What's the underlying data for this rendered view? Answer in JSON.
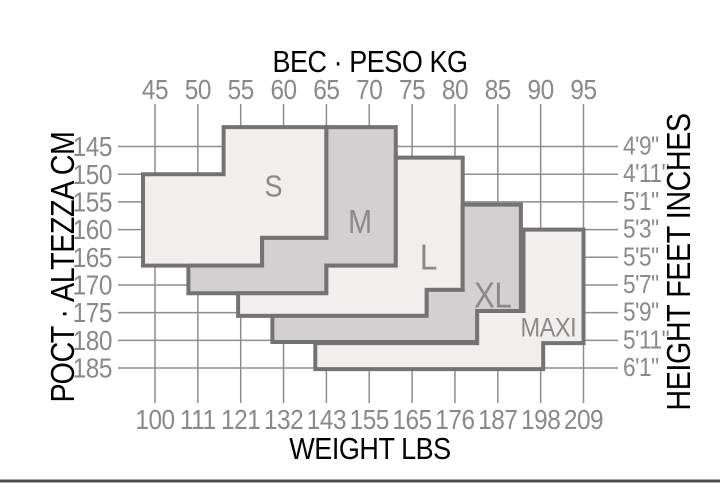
{
  "page": {
    "background": "#ffffff"
  },
  "chart_data": {
    "type": "area",
    "subtype": "stepped-size-regions",
    "title_top": "ВЕС · PESO KG",
    "title_bottom": "WEIGHT LBS",
    "title_left": "РОСТ · ALTEZZA CM",
    "title_right": "HEIGHT FEET INCHES",
    "x_axis": {
      "top_unit": "kg",
      "bottom_unit": "lbs",
      "kg_range": [
        45,
        95
      ]
    },
    "y_axis": {
      "left_unit": "cm",
      "right_unit": "feet/inches",
      "cm_range": [
        145,
        185
      ]
    },
    "colors": {
      "light_fill": "#f1efee",
      "dark_fill": "#d3d0d1",
      "region_border": "#757273",
      "grid_line": "#8e8c8c",
      "text": "#8a8888",
      "divider": "#4f4f4f"
    },
    "plot": {
      "x0": 155,
      "x1": 583.5,
      "kg0": 45,
      "kg1": 95,
      "y0": 146.5,
      "y1": 368,
      "cm0": 145,
      "cm1": 185
    },
    "top_ticks": [
      {
        "label": "45",
        "kg": 45,
        "to_cm": 150
      },
      {
        "label": "50",
        "kg": 50,
        "to_cm": 150
      },
      {
        "label": "55",
        "kg": 55,
        "to_cm": 141.5
      },
      {
        "label": "60",
        "kg": 60,
        "to_cm": 141.5
      },
      {
        "label": "65",
        "kg": 65,
        "to_cm": 141.5
      },
      {
        "label": "70",
        "kg": 70,
        "to_cm": 141.5
      },
      {
        "label": "75",
        "kg": 75,
        "to_cm": 147
      },
      {
        "label": "80",
        "kg": 80,
        "to_cm": 147
      },
      {
        "label": "85",
        "kg": 85,
        "to_cm": 155.5
      },
      {
        "label": "90",
        "kg": 90,
        "to_cm": 160
      },
      {
        "label": "95",
        "kg": 95,
        "to_cm": 160
      }
    ],
    "left_ticks": [
      {
        "label": "145",
        "cm": 145,
        "to_kg": 53
      },
      {
        "label": "150",
        "cm": 150,
        "to_kg": 43.6
      },
      {
        "label": "155",
        "cm": 155,
        "to_kg": 43.6
      },
      {
        "label": "160",
        "cm": 160,
        "to_kg": 43.6
      },
      {
        "label": "165",
        "cm": 165,
        "to_kg": 43.6
      },
      {
        "label": "170",
        "cm": 170,
        "to_kg": 48.9
      },
      {
        "label": "175",
        "cm": 175,
        "to_kg": 54.7
      },
      {
        "label": "180",
        "cm": 180,
        "to_kg": 58.7
      },
      {
        "label": "185",
        "cm": 185,
        "to_kg": 63.7
      }
    ],
    "right_ticks": [
      {
        "label": "4'9\"",
        "cm": 145,
        "from_kg": 73.1
      },
      {
        "label": "4'11\"",
        "cm": 150,
        "from_kg": 80.9
      },
      {
        "label": "5'1\"",
        "cm": 155,
        "from_kg": 80.9
      },
      {
        "label": "5'3\"",
        "cm": 160,
        "from_kg": 87.7
      },
      {
        "label": "5'5\"",
        "cm": 165,
        "from_kg": 95
      },
      {
        "label": "5'7\"",
        "cm": 170,
        "from_kg": 95
      },
      {
        "label": "5'9\"",
        "cm": 175,
        "from_kg": 95
      },
      {
        "label": "5'11\"",
        "cm": 180,
        "from_kg": 90.3
      },
      {
        "label": "6'1\"",
        "cm": 185,
        "from_kg": 90.3
      }
    ],
    "bottom_ticks": [
      {
        "label": "100",
        "kg": 45,
        "from_cm": 166.5
      },
      {
        "label": "111",
        "kg": 50,
        "from_cm": 171.5
      },
      {
        "label": "121",
        "kg": 55,
        "from_cm": 175.6
      },
      {
        "label": "132",
        "kg": 60,
        "from_cm": 180.3
      },
      {
        "label": "143",
        "kg": 65,
        "from_cm": 185.2
      },
      {
        "label": "155",
        "kg": 70,
        "from_cm": 185.2
      },
      {
        "label": "165",
        "kg": 75,
        "from_cm": 185.2
      },
      {
        "label": "176",
        "kg": 80,
        "from_cm": 185.2
      },
      {
        "label": "187",
        "kg": 85,
        "from_cm": 185.2
      },
      {
        "label": "198",
        "kg": 90,
        "from_cm": 185.2
      },
      {
        "label": "209",
        "kg": 95,
        "from_cm": 180.5
      }
    ],
    "regions": [
      {
        "name": "S",
        "fill": "light",
        "points": [
          [
            53,
            141.5
          ],
          [
            65,
            141.5
          ],
          [
            65,
            161.5
          ],
          [
            57.5,
            161.5
          ],
          [
            57.5,
            166.5
          ],
          [
            43.6,
            166.5
          ],
          [
            43.6,
            150
          ],
          [
            53,
            150
          ]
        ],
        "label": {
          "text": "S",
          "kg": 58.8,
          "cm": 152.3,
          "size": 31
        }
      },
      {
        "name": "M",
        "fill": "dark",
        "points": [
          [
            65,
            141.5
          ],
          [
            73.1,
            141.5
          ],
          [
            73.1,
            166.5
          ],
          [
            65,
            166.5
          ],
          [
            65,
            171.5
          ],
          [
            48.9,
            171.5
          ],
          [
            48.9,
            166.5
          ],
          [
            57.5,
            166.5
          ],
          [
            57.5,
            161.5
          ],
          [
            65,
            161.5
          ]
        ],
        "label": {
          "text": "M",
          "kg": 68.9,
          "cm": 158.6,
          "size": 33
        }
      },
      {
        "name": "L",
        "fill": "light",
        "points": [
          [
            73.1,
            147
          ],
          [
            80.9,
            147
          ],
          [
            80.9,
            170.9
          ],
          [
            76.7,
            170.9
          ],
          [
            76.7,
            175.6
          ],
          [
            54.7,
            175.6
          ],
          [
            54.7,
            171.5
          ],
          [
            65,
            171.5
          ],
          [
            65,
            166.5
          ],
          [
            73.1,
            166.5
          ]
        ],
        "label": {
          "text": "L",
          "kg": 76.9,
          "cm": 165.1,
          "size": 36
        }
      },
      {
        "name": "XL",
        "fill": "dark",
        "points": [
          [
            80.9,
            155.5
          ],
          [
            87.7,
            155.5
          ],
          [
            87.7,
            174.7
          ],
          [
            82.6,
            174.7
          ],
          [
            82.6,
            180.3
          ],
          [
            58.7,
            180.3
          ],
          [
            58.7,
            175.6
          ],
          [
            76.7,
            175.6
          ],
          [
            76.7,
            170.9
          ],
          [
            80.9,
            170.9
          ]
        ],
        "label": {
          "text": "XL",
          "kg": 84.4,
          "cm": 172,
          "size": 36
        }
      },
      {
        "name": "MAXI",
        "fill": "light",
        "points": [
          [
            88,
            160
          ],
          [
            95,
            160
          ],
          [
            95,
            180.5
          ],
          [
            90.3,
            180.5
          ],
          [
            90.3,
            185.2
          ],
          [
            63.7,
            185.2
          ],
          [
            63.7,
            180.5
          ],
          [
            82.6,
            180.5
          ],
          [
            82.6,
            174.7
          ],
          [
            88,
            174.7
          ]
        ],
        "label": {
          "text": "MAXI",
          "kg": 90.9,
          "cm": 177.8,
          "size": 27
        }
      }
    ]
  }
}
